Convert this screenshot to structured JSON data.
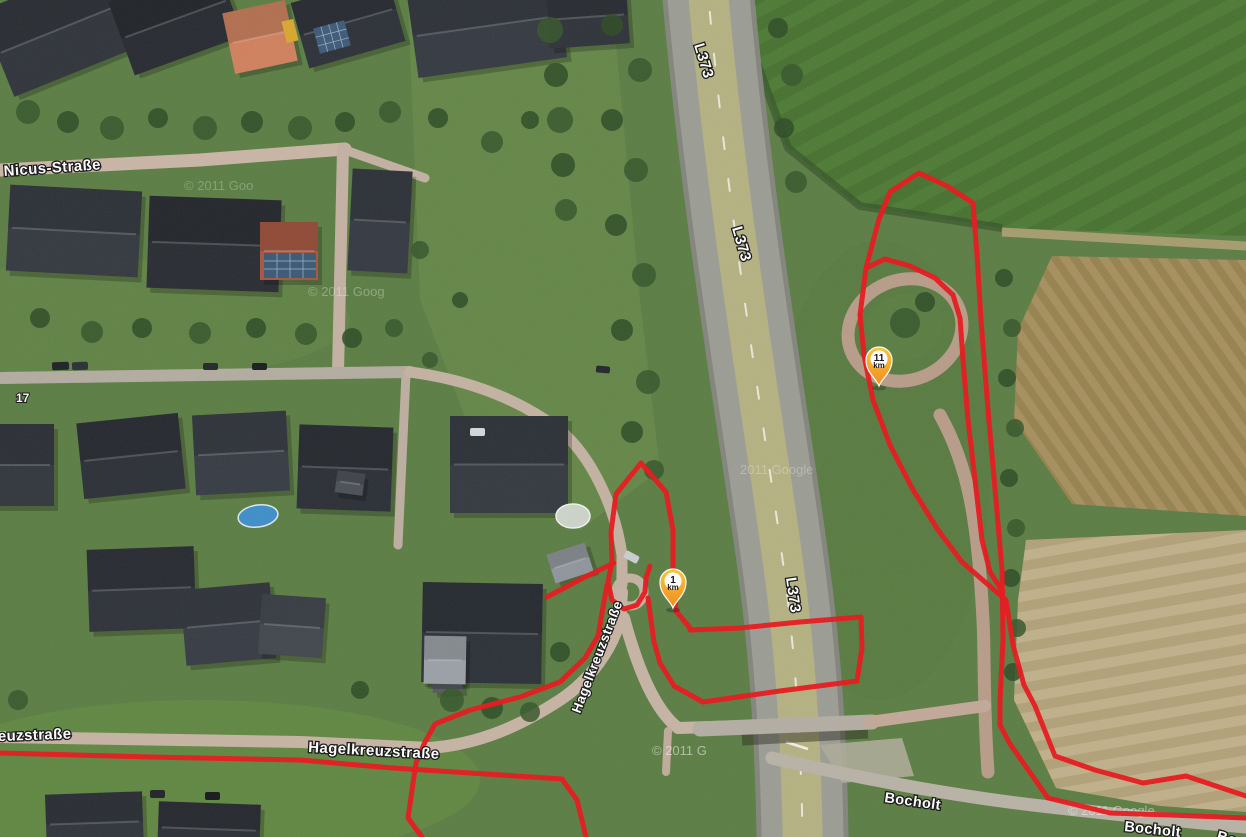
{
  "map": {
    "labels": [
      {
        "text": "L373"
      },
      {
        "text": "L373"
      },
      {
        "text": "L373"
      },
      {
        "text": "Nicus-Straße"
      },
      {
        "text": "17"
      },
      {
        "text": "euzstraße"
      },
      {
        "text": "Hagelkreuzstraße"
      },
      {
        "text": "Hagelkreuzstraße"
      },
      {
        "text": "Bocholt"
      },
      {
        "text": "Bocholt"
      },
      {
        "text": "Bocholt"
      }
    ],
    "markers": [
      {
        "value": "11",
        "unit": "km"
      },
      {
        "value": "1",
        "unit": "km"
      }
    ],
    "watermarks": [
      "© 2011 Goog",
      "2011 Google",
      "© 2011 G",
      "© 2011 Google",
      "© 2011 Goo"
    ],
    "track_color": "#e8161a",
    "marker_color": "#f9a825",
    "imagery_type": "satellite"
  }
}
